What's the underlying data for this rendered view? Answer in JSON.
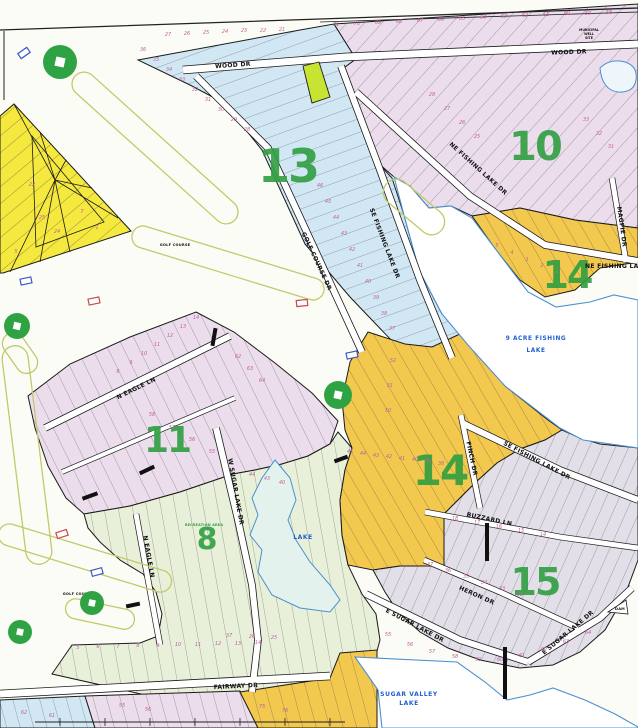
{
  "sections": {
    "s13": {
      "number": "13"
    },
    "s10": {
      "number": "10"
    },
    "s14ne": {
      "number": "14"
    },
    "s11": {
      "number": "11"
    },
    "s14c": {
      "number": "14"
    },
    "s8": {
      "number": "8"
    },
    "s15": {
      "number": "15"
    }
  },
  "streets": {
    "wood_dr_w": "WOOD DR",
    "wood_dr_e": "WOOD DR",
    "golf_course_dr": "GOLF COURSE DR",
    "se_fishing_lake_dr_13": "SE FISHING LAKE DR",
    "ne_fishing_lake_dr": "NE FISHING LAKE DR",
    "magpie_dr": "MAGPIE DR",
    "ne_fishing_la": "NE FISHING LA",
    "n_eagle_ln": "N EAGLE LN",
    "n_eagle_ln_s": "N EAGLE LN",
    "w_sugar_lake_dr": "W SUGAR LAKE DR",
    "finch_dr": "FINCH DR",
    "se_fishing_lake_dr_15": "SE FISHING LAKE DR",
    "buzzard_ln": "BUZZARD LN",
    "heron_dr": "HERON DR",
    "e_sugar_lake_dr_w": "E SUGAR LAKE DR",
    "e_sugar_lake_dr_e": "E SUGAR LAKE DR",
    "fairway_dr": "FAIRWAY DR"
  },
  "water": {
    "nine_acre_line1": "9 ACRE FISHING",
    "nine_acre_line2": "LAKE",
    "small_lake": "LAKE",
    "sugar_valley_line1": "SUGAR VALLEY",
    "sugar_valley_line2": "LAKE"
  },
  "labels": {
    "golf_course_upper": "GOLF COURSE",
    "golf_course_lower": "GOLF COURSE",
    "recreation_area": "RECREATION AREA",
    "well_site_line1": "MUNICIPAL",
    "well_site_line2": "WELL",
    "well_site_line3": "SITE",
    "dam": "DAM"
  },
  "colors": {
    "paper": "#fcfcf7",
    "section_blue": "#d2e7f4",
    "section_pink": "#ecdded",
    "section_gray": "#e3dfe9",
    "section_orange": "#f2c84e",
    "section_green": "#e8f0da",
    "section_yellow": "#f5e83e",
    "highlight_lot": "#c6e431",
    "number_green": "#2f9e41",
    "lot_number_pink": "#c0629f",
    "water_blue": "#4a90d0",
    "label_blue": "#1f5fd0",
    "golf_outline": "#c3c96a",
    "marker_green": "#2fa344"
  },
  "lot_numbers": [
    [
      71,
      336,
      26
    ],
    [
      70,
      357,
      25
    ],
    [
      69,
      378,
      24
    ],
    [
      68,
      399,
      23
    ],
    [
      67,
      420,
      22
    ],
    [
      66,
      441,
      21
    ],
    [
      65,
      462,
      20
    ],
    [
      64,
      483,
      19
    ],
    [
      63,
      504,
      18
    ],
    [
      62,
      525,
      17
    ],
    [
      61,
      546,
      16
    ],
    [
      60,
      567,
      15
    ],
    [
      59,
      588,
      15
    ],
    [
      58,
      609,
      14
    ],
    [
      27,
      168,
      36
    ],
    [
      26,
      187,
      35
    ],
    [
      25,
      206,
      34
    ],
    [
      24,
      225,
      33
    ],
    [
      23,
      244,
      32
    ],
    [
      22,
      263,
      32
    ],
    [
      21,
      282,
      31
    ],
    [
      36,
      143,
      51
    ],
    [
      35,
      156,
      61
    ],
    [
      34,
      169,
      71
    ],
    [
      33,
      182,
      81
    ],
    [
      32,
      195,
      91
    ],
    [
      31,
      208,
      101
    ],
    [
      30,
      221,
      111
    ],
    [
      29,
      234,
      121
    ],
    [
      28,
      247,
      131
    ],
    [
      46,
      320,
      187
    ],
    [
      45,
      328,
      203
    ],
    [
      44,
      336,
      219
    ],
    [
      43,
      344,
      235
    ],
    [
      42,
      352,
      251
    ],
    [
      41,
      360,
      267
    ],
    [
      40,
      368,
      283
    ],
    [
      39,
      376,
      299
    ],
    [
      38,
      384,
      315
    ],
    [
      37,
      392,
      330
    ],
    [
      28,
      432,
      96
    ],
    [
      27,
      447,
      110
    ],
    [
      26,
      462,
      124
    ],
    [
      25,
      477,
      138
    ],
    [
      33,
      586,
      121
    ],
    [
      32,
      599,
      135
    ],
    [
      31,
      611,
      148
    ],
    [
      5,
      497,
      247
    ],
    [
      4,
      512,
      254
    ],
    [
      3,
      527,
      261
    ],
    [
      2,
      542,
      267
    ],
    [
      1,
      557,
      273
    ],
    [
      14,
      196,
      319
    ],
    [
      13,
      183,
      328
    ],
    [
      12,
      170,
      337
    ],
    [
      11,
      157,
      346
    ],
    [
      10,
      144,
      355
    ],
    [
      9,
      131,
      364
    ],
    [
      8,
      118,
      373
    ],
    [
      58,
      152,
      416
    ],
    [
      57,
      172,
      429
    ],
    [
      56,
      192,
      441
    ],
    [
      55,
      212,
      453
    ],
    [
      62,
      238,
      358
    ],
    [
      63,
      250,
      370
    ],
    [
      64,
      262,
      382
    ],
    [
      44,
      252,
      476
    ],
    [
      43,
      267,
      480
    ],
    [
      40,
      282,
      484
    ],
    [
      5,
      78,
      649
    ],
    [
      6,
      98,
      648
    ],
    [
      7,
      118,
      648
    ],
    [
      8,
      138,
      647
    ],
    [
      9,
      158,
      647
    ],
    [
      10,
      178,
      646
    ],
    [
      11,
      198,
      646
    ],
    [
      12,
      218,
      645
    ],
    [
      13,
      238,
      645
    ],
    [
      14,
      258,
      644
    ],
    [
      37,
      229,
      637
    ],
    [
      26,
      252,
      638
    ],
    [
      25,
      274,
      639
    ],
    [
      45,
      350,
      453
    ],
    [
      44,
      363,
      455
    ],
    [
      43,
      376,
      457
    ],
    [
      42,
      389,
      458
    ],
    [
      41,
      402,
      460
    ],
    [
      40,
      415,
      461
    ],
    [
      39,
      428,
      463
    ],
    [
      38,
      441,
      465
    ],
    [
      52,
      393,
      362
    ],
    [
      51,
      390,
      387
    ],
    [
      50,
      388,
      412
    ],
    [
      37,
      430,
      566
    ],
    [
      36,
      448,
      572
    ],
    [
      35,
      466,
      578
    ],
    [
      34,
      484,
      584
    ],
    [
      33,
      502,
      590
    ],
    [
      32,
      520,
      596
    ],
    [
      55,
      388,
      636
    ],
    [
      56,
      410,
      646
    ],
    [
      57,
      432,
      653
    ],
    [
      58,
      455,
      658
    ],
    [
      59,
      478,
      661
    ],
    [
      60,
      500,
      661
    ],
    [
      61,
      522,
      657
    ],
    [
      62,
      544,
      651
    ],
    [
      63,
      566,
      643
    ],
    [
      64,
      588,
      634
    ],
    [
      18,
      455,
      520
    ],
    [
      17,
      477,
      524
    ],
    [
      16,
      499,
      528
    ],
    [
      15,
      521,
      532
    ],
    [
      14,
      543,
      536
    ],
    [
      22,
      32,
      186
    ],
    [
      25,
      42,
      219
    ],
    [
      24,
      57,
      233
    ],
    [
      7,
      82,
      213
    ],
    [
      1,
      97,
      229
    ],
    [
      5,
      16,
      253
    ],
    [
      62,
      24,
      714
    ],
    [
      61,
      52,
      717
    ],
    [
      55,
      122,
      707
    ],
    [
      56,
      148,
      711
    ],
    [
      75,
      262,
      708
    ],
    [
      76,
      285,
      712
    ]
  ],
  "golf_markers": [
    [
      60,
      62,
      17
    ],
    [
      17,
      326,
      13
    ],
    [
      338,
      395,
      14
    ],
    [
      92,
      603,
      12
    ],
    [
      20,
      632,
      12
    ]
  ],
  "tee_rects": {
    "blue": [
      [
        24,
        53,
        -35
      ],
      [
        26,
        281,
        -12
      ],
      [
        97,
        572,
        -15
      ],
      [
        352,
        355,
        -12
      ]
    ],
    "red": [
      [
        94,
        301,
        -12
      ],
      [
        302,
        303,
        -6
      ],
      [
        62,
        534,
        -18
      ]
    ]
  },
  "black_bars": [
    [
      214,
      337,
      4,
      18,
      10
    ],
    [
      147,
      470,
      16,
      4,
      -25
    ],
    [
      90,
      496,
      16,
      4,
      -20
    ],
    [
      341,
      459,
      14,
      4,
      -20
    ],
    [
      487,
      542,
      4,
      38,
      0
    ],
    [
      505,
      673,
      4,
      52,
      0
    ],
    [
      133,
      605,
      14,
      4,
      -12
    ]
  ]
}
